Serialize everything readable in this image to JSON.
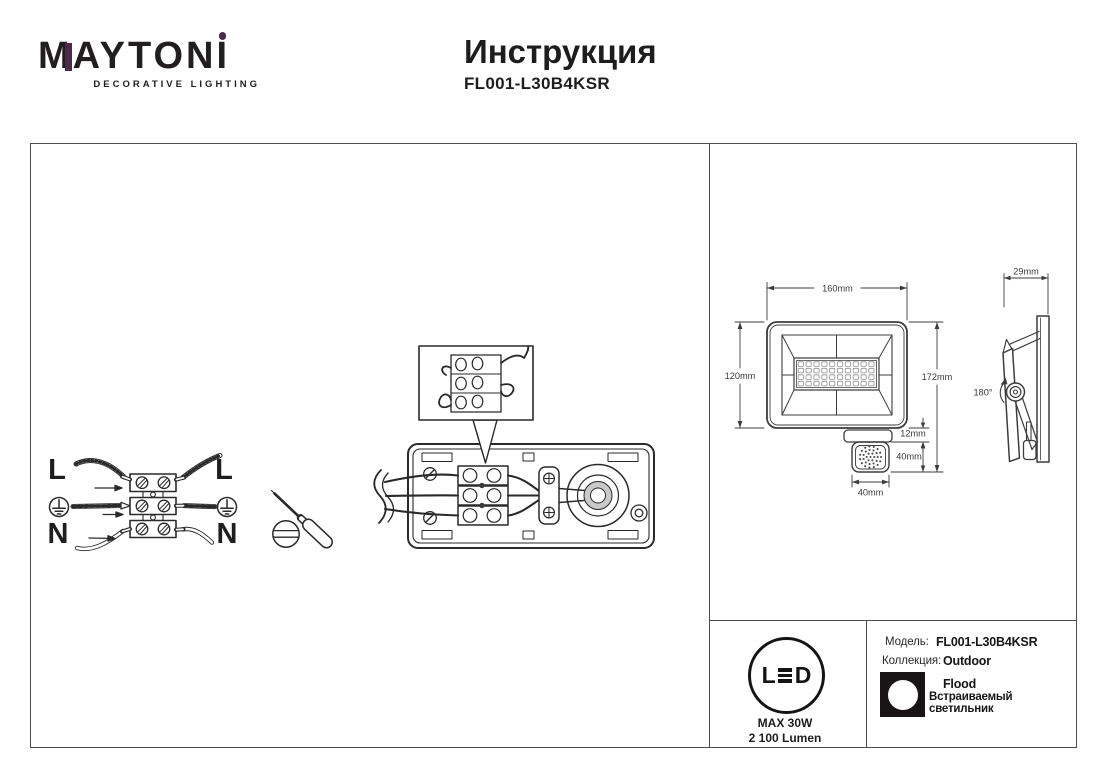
{
  "header": {
    "brand_m": "M",
    "brand_mid": "AYTON",
    "brand_i": "I",
    "tagline": "DECORATIVE LIGHTING",
    "title": "Инструкция",
    "model": "FL001-L30B4KSR",
    "accent_color": "#4e2a49"
  },
  "wiring": {
    "live_left": "L",
    "live_right": "L",
    "neutral_left": "N",
    "neutral_right": "N"
  },
  "dimensions": {
    "body_width": "160mm",
    "body_height": "120mm",
    "overall_height": "172mm",
    "bracket_gap": "12mm",
    "sensor_height": "40mm",
    "sensor_width": "40mm",
    "depth": "29mm",
    "rotation": "180°"
  },
  "badge": {
    "led_l": "L",
    "led_d": "D",
    "max_power": "MAX 30W",
    "lumen": "2 100 Lumen"
  },
  "info": {
    "model_label": "Модель:",
    "model_value": "FL001-L30B4KSR",
    "collection_label": "Коллекция:",
    "collection_value": "Outdoor",
    "type_en": "Flood",
    "type_ru": "Встраиваемый светильник"
  }
}
